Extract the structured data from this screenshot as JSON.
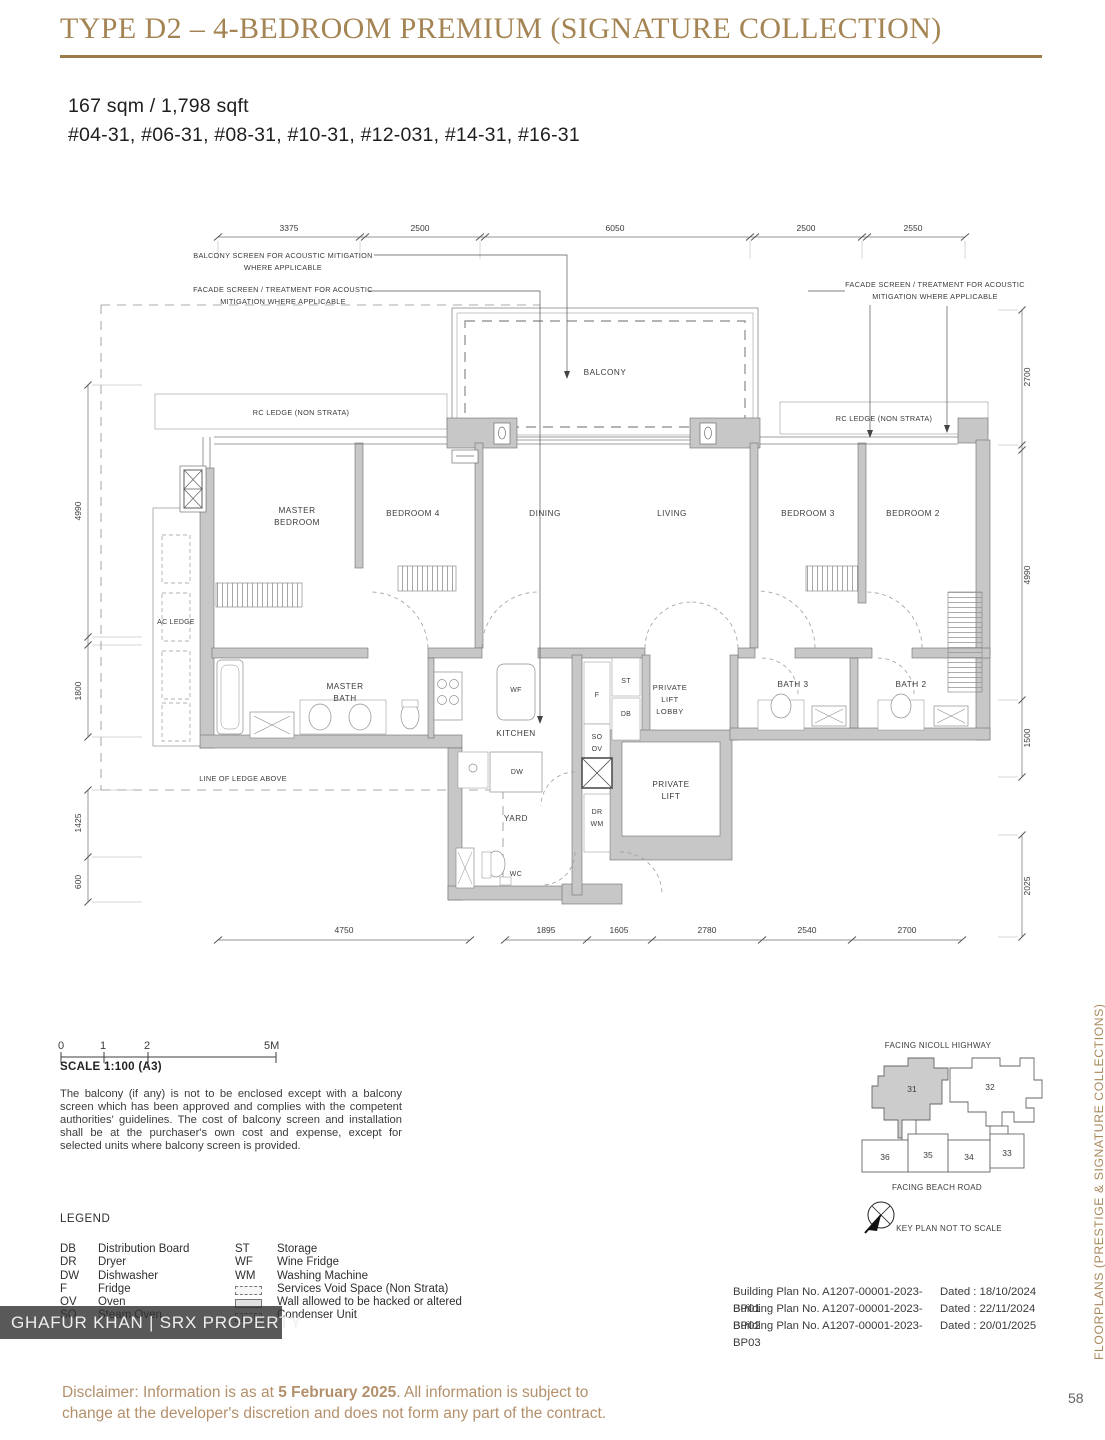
{
  "page": {
    "title": "TYPE D2 – 4-BEDROOM PREMIUM (SIGNATURE COLLECTION)",
    "area": "167 sqm / 1,798 sqft",
    "units": "#04-31, #06-31, #08-31, #10-31, #12-031, #14-31, #16-31",
    "page_number": "58",
    "side_label": "FLOORPLANS (PRESTIGE & SIGNATURE COLLECTIONS)",
    "watermark": "GHAFUR KHAN | SRX PROPERTY"
  },
  "plan": {
    "dims": {
      "top": [
        "3375",
        "2500",
        "6050",
        "2500",
        "2550"
      ],
      "bottom": [
        "4750",
        "1895",
        "1605",
        "2780",
        "2540",
        "2700"
      ],
      "left": [
        "4990",
        "1800",
        "1425",
        "600"
      ],
      "right": [
        "2700",
        "4990",
        "1500",
        "2025"
      ]
    },
    "annotations": {
      "balcony_screen_1": "BALCONY SCREEN FOR ACOUSTIC MITIGATION",
      "balcony_screen_2": "WHERE APPLICABLE",
      "facade_1": "FACADE SCREEN / TREATMENT FOR ACOUSTIC",
      "facade_2": "MITIGATION WHERE APPLICABLE",
      "rc_ledge": "RC LEDGE (NON STRATA)",
      "line_of_ledge": "LINE OF LEDGE ABOVE",
      "ac_ledge": "AC LEDGE"
    },
    "rooms": {
      "balcony": "BALCONY",
      "master_1": "MASTER",
      "master_2": "BEDROOM",
      "bed4": "BEDROOM 4",
      "dining": "DINING",
      "living": "LIVING",
      "bed3": "BEDROOM 3",
      "bed2": "BEDROOM 2",
      "mbath_1": "MASTER",
      "mbath_2": "BATH",
      "kitchen": "KITCHEN",
      "bath3": "BATH 3",
      "bath2": "BATH 2",
      "lobby_1": "PRIVATE",
      "lobby_2": "LIFT",
      "lobby_3": "LOBBY",
      "lift_1": "PRIVATE",
      "lift_2": "LIFT",
      "yard": "YARD",
      "wc": "WC"
    },
    "appliances": {
      "wf": "WF",
      "f": "F",
      "st": "ST",
      "db": "DB",
      "so": "SO",
      "ov": "OV",
      "dw": "DW",
      "dr": "DR",
      "wm": "WM"
    }
  },
  "scalebar": {
    "t0": "0",
    "t1": "1",
    "t2": "2",
    "t5": "5M",
    "label": "SCALE 1:100 (A3)"
  },
  "balcony_note": "The balcony (if any) is not to be enclosed except with a balcony screen which has been approved and complies with the competent authorities' guidelines. The cost of balcony screen and installation shall be at the purchaser's own cost and expense, except for selected units where balcony screen is provided.",
  "legend": {
    "title": "LEGEND",
    "left": [
      {
        "abbr": "DB",
        "label": "Distribution Board"
      },
      {
        "abbr": "DR",
        "label": "Dryer"
      },
      {
        "abbr": "DW",
        "label": "Dishwasher"
      },
      {
        "abbr": "F",
        "label": "Fridge"
      },
      {
        "abbr": "OV",
        "label": "Oven"
      },
      {
        "abbr": "SO",
        "label": "Steam Oven"
      }
    ],
    "right": [
      {
        "abbr": "ST",
        "label": "Storage"
      },
      {
        "abbr": "WF",
        "label": "Wine Fridge"
      },
      {
        "abbr": "WM",
        "label": "Washing Machine"
      }
    ],
    "symbols": [
      "Services Void Space (Non Strata)",
      "Wall allowed to be hacked or altered",
      "Condenser Unit"
    ]
  },
  "keyplan": {
    "facing_top": "FACING NICOLL HIGHWAY",
    "facing_bottom": "FACING BEACH ROAD",
    "note": "KEY PLAN NOT TO SCALE",
    "b31": "31",
    "b32": "32",
    "b33": "33",
    "b34": "34",
    "b35": "35",
    "b36": "36"
  },
  "building_plans": [
    {
      "no": "Building Plan No. A1207-00001-2023-BP01",
      "date": "Dated : 18/10/2024"
    },
    {
      "no": "Building Plan No. A1207-00001-2023-BP02",
      "date": "Dated : 22/11/2024"
    },
    {
      "no": "Building Plan No. A1207-00001-2023-BP03",
      "date": "Dated : 20/01/2025"
    }
  ],
  "disclaimer": {
    "pre": "Disclaimer: Information is as at ",
    "date": "5 February 2025",
    "post": ". All information is subject to change at the developer's discretion and does not form any part of the contract."
  }
}
